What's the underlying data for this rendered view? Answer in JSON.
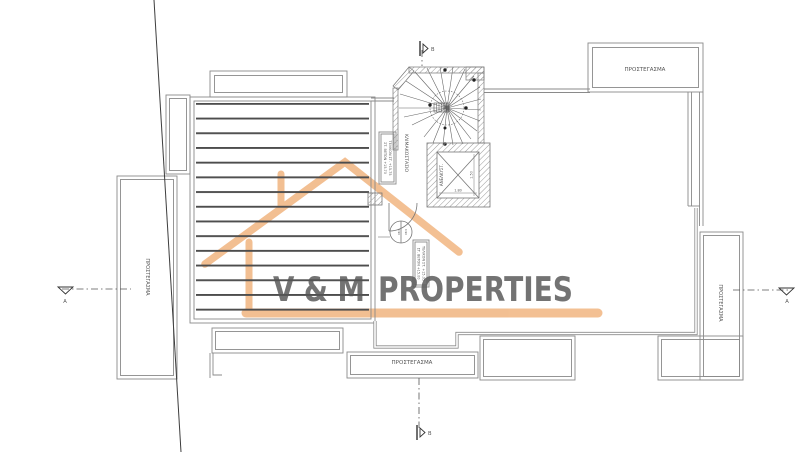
{
  "drawing": {
    "labels": {
      "prostegasma_top_right": "ΠΡΟΣΤΕΓΑΣΜΑ",
      "prostegasma_left": "ΠΡΟΣΤΕΓΑΣΜΑ",
      "prostegasma_bottom": "ΠΡΟΣΤΕΓΑΣΜΑ",
      "prostegasma_right": "ΠΡΟΣΤΕΓΑΣΜΑ",
      "staircase": "ΚΛΙΜΑΚΟΣΤΑΣΙΟ",
      "elevator": "ΑΝΕΛΚΥΣΤ."
    },
    "notes": {
      "stair_line1": "ΤΕΛΙΚΟΝ ΣΤ. +15.75",
      "stair_line2": "ΣΤ. BETON +15.70",
      "roof_line1": "ΤΕΛΙΚΟΝ ΣΤ. +15.05",
      "roof_line2": "ΣΤ. BETON +15.00"
    },
    "dimensions": {
      "elevator_width": "1.80",
      "elevator_depth": "1.50",
      "level_left": "0.90",
      "level_right": "0.90"
    },
    "section_markers": {
      "a_left": "A",
      "a_right": "A",
      "b_top": "B",
      "b_bottom": "B"
    },
    "colors": {
      "line": "#8a8a8a",
      "hatch": "#4d4d4d",
      "boundary": "#3d3d3d"
    }
  },
  "watermark": {
    "name_left": "V & M",
    "name_right": "PROPERTIES",
    "house_color": "#f0b078",
    "text_color": "#a1a1a1"
  }
}
